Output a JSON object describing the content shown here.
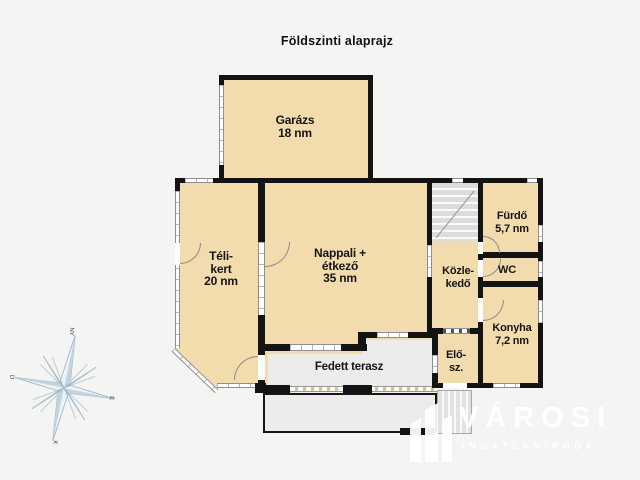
{
  "title": "Földszinti alaprajz",
  "rooms": {
    "garazs": {
      "name": "Garázs",
      "area": "18 nm"
    },
    "telikert": {
      "name_line1": "Téli-",
      "name_line2": "kert",
      "area": "20 nm"
    },
    "nappali": {
      "name_line1": "Nappali +",
      "name_line2": "étkező",
      "area": "35 nm"
    },
    "furdo": {
      "name": "Fürdő",
      "area": "5,7 nm"
    },
    "wc": {
      "name": "WC"
    },
    "kozlekedo": {
      "name_line1": "Közle-",
      "name_line2": "kedő"
    },
    "konyha": {
      "name": "Konyha",
      "area": "7,2 nm"
    },
    "elosz": {
      "name_line1": "Elő-",
      "name_line2": "sz."
    },
    "fedett_terasz": {
      "name": "Fedett terasz"
    }
  },
  "compass": {
    "top": "NY",
    "right": "É",
    "bottom": "K",
    "left": "D"
  },
  "watermark": {
    "brand": "VÁROSI",
    "tagline": "INGATLANIRODA"
  },
  "colors": {
    "room_fill": "#f2dcae",
    "wall": "#131313",
    "terrace_fill": "#ececec",
    "background": "#f4f4f2",
    "window": "#ffffff",
    "compass_stroke": "#9fb8c6",
    "watermark": "#ffffff"
  }
}
